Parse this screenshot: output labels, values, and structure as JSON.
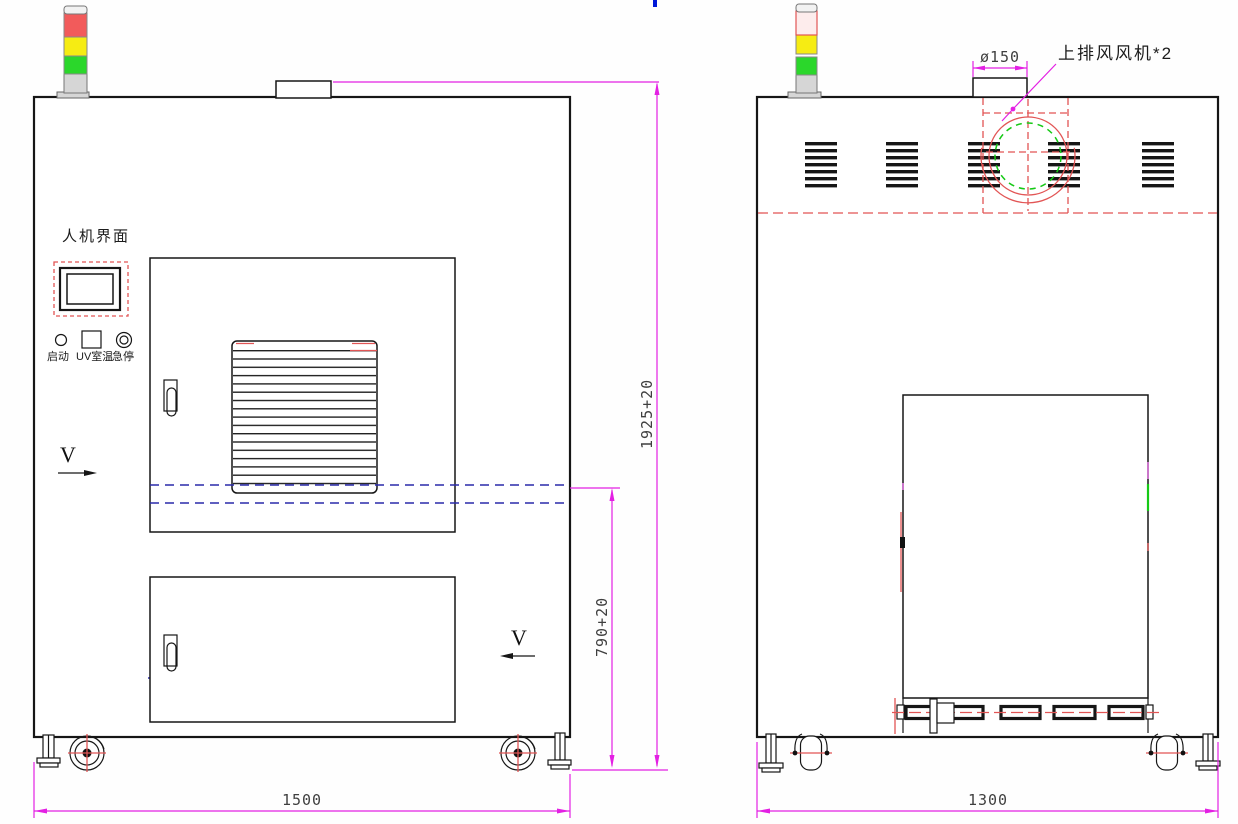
{
  "drawing": {
    "front_view": {
      "hmi_label": "人机界面",
      "buttons": {
        "start": "启动",
        "uv_temp": "UV室温",
        "estop": "急停"
      },
      "section_mark_left": "V",
      "section_mark_right": "V",
      "dim_width": "1500",
      "dim_total_height": "1925+20",
      "dim_work_height": "790+20"
    },
    "side_view": {
      "fan_callout": "上排风风机*2",
      "dim_fan_diameter": "ø150",
      "dim_depth": "1300"
    },
    "colors": {
      "dim_line": "#e320e3",
      "red_dash": "#e25555",
      "blue_dash": "#2a2aaa",
      "green_dash": "#16c916",
      "outline": "#161616",
      "dim_text": "#3f3f3f",
      "tower_red": "#f25b5b",
      "tower_yellow": "#f6ec13",
      "tower_green": "#2bd72b",
      "tower_gray": "#d6d6d6"
    }
  }
}
